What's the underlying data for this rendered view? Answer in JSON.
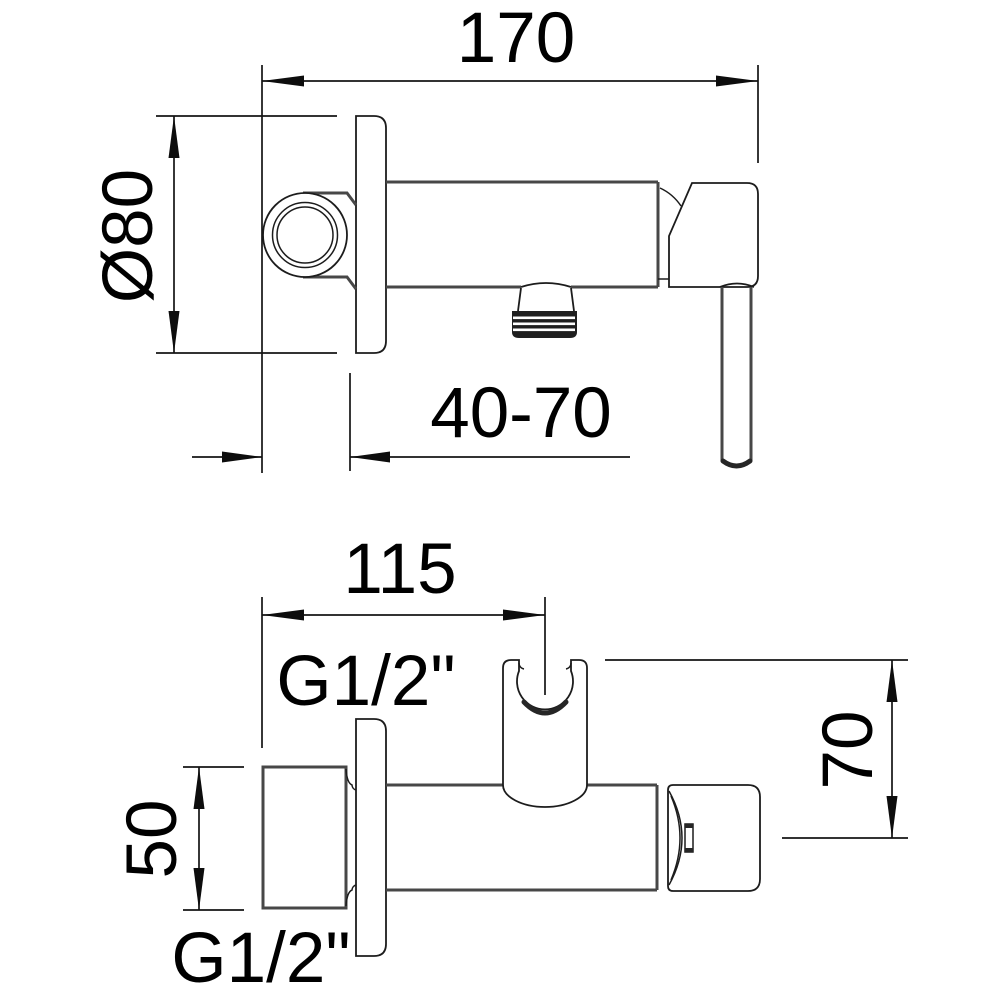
{
  "drawing": {
    "type": "bidet-mixer-installation-drawing",
    "units": "mm",
    "colors": {
      "line": "#1c1c1c",
      "silhouette": "#474747",
      "background": "#ffffff",
      "text": "#000000"
    },
    "side_view": {
      "overall_length": "170",
      "plate_diameter": "Ø80",
      "mounting_depth_range": "40-70"
    },
    "plan_view": {
      "inlet_to_holder": "115",
      "thread_top": "G1/2\"",
      "inlet_height": "50",
      "thread_bottom": "G1/2\"",
      "holder_height": "70"
    }
  }
}
